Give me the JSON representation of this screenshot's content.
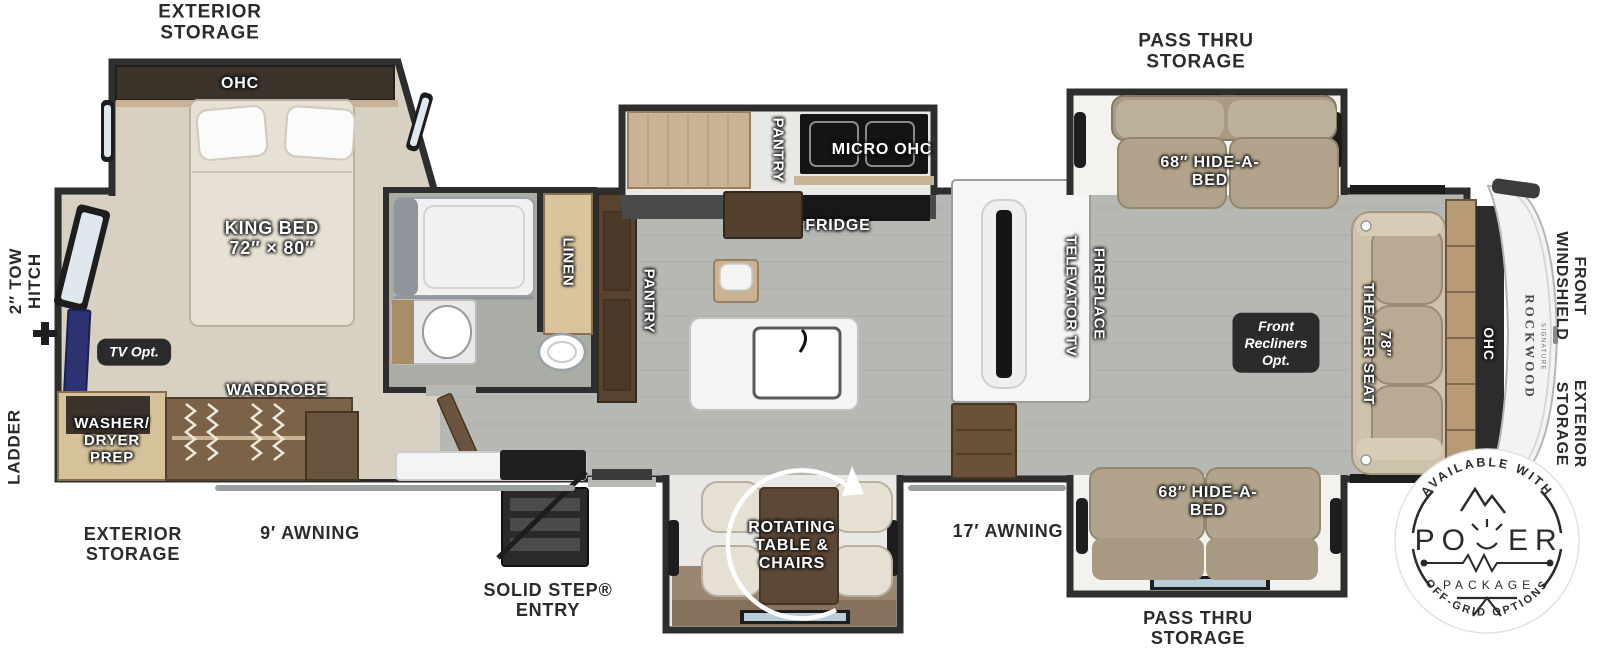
{
  "labels": {
    "exterior_storage_top": "EXTERIOR\nSTORAGE",
    "pass_thru_storage_top": "PASS THRU\nSTORAGE",
    "tow_hitch": "2″ TOW\nHITCH",
    "ladder": "LADDER",
    "ohc_bedroom": "OHC",
    "king_bed": "KING BED\n72″ × 80″",
    "tv_opt": "TV Opt.",
    "washer_dryer": "WASHER/\nDRYER\nPREP",
    "wardrobe": "WARDROBE",
    "exterior_storage_bottom": "EXTERIOR\nSTORAGE",
    "awning_9": "9′ AWNING",
    "linen": "LINEN",
    "pantry_lower": "PANTRY",
    "pantry_upper": "PANTRY",
    "micro_ohc": "MICRO OHC",
    "fridge": "FRIDGE",
    "solid_step": "SOLID STEP®\nENTRY",
    "rotating_table": "ROTATING\nTABLE &\nCHAIRS",
    "awning_17": "17′ AWNING",
    "televator_tv": "TELEVATOR TV",
    "fireplace": "FIREPLACE",
    "hide_a_bed_top": "68″ HIDE-A-\nBED",
    "hide_a_bed_bottom": "68″ HIDE-A-\nBED",
    "pass_thru_storage_bottom": "PASS THRU\nSTORAGE",
    "front_recliners": "Front\nRecliners\nOpt.",
    "theater_seat": "78″\nTHEATER SEAT",
    "ohc_front": "OHC",
    "rockwood": "ROCKWOOD",
    "rockwood_sub": "SIGNATURE",
    "front_windshield": "FRONT\nWINDSHIELD",
    "exterior_storage_right": "EXTERIOR\nSTORAGE"
  },
  "badge": {
    "arc_top": "AVAILABLE WITH",
    "power_left": "PO",
    "power_right": "ER",
    "package": "PACKAGE",
    "arc_bottom": "OFF-GRID OPTIONS"
  },
  "colors": {
    "wall": "#2e2e2e",
    "floor_wood": "#b6b9b3",
    "carpet": "#d8d1c1",
    "cabinet_wood": "#c9b394",
    "cabinet_dark": "#57432f",
    "sofa_tan": "#b2a48c",
    "label_ink": "#2b2b2b",
    "tv_blue": "#2c3272"
  }
}
